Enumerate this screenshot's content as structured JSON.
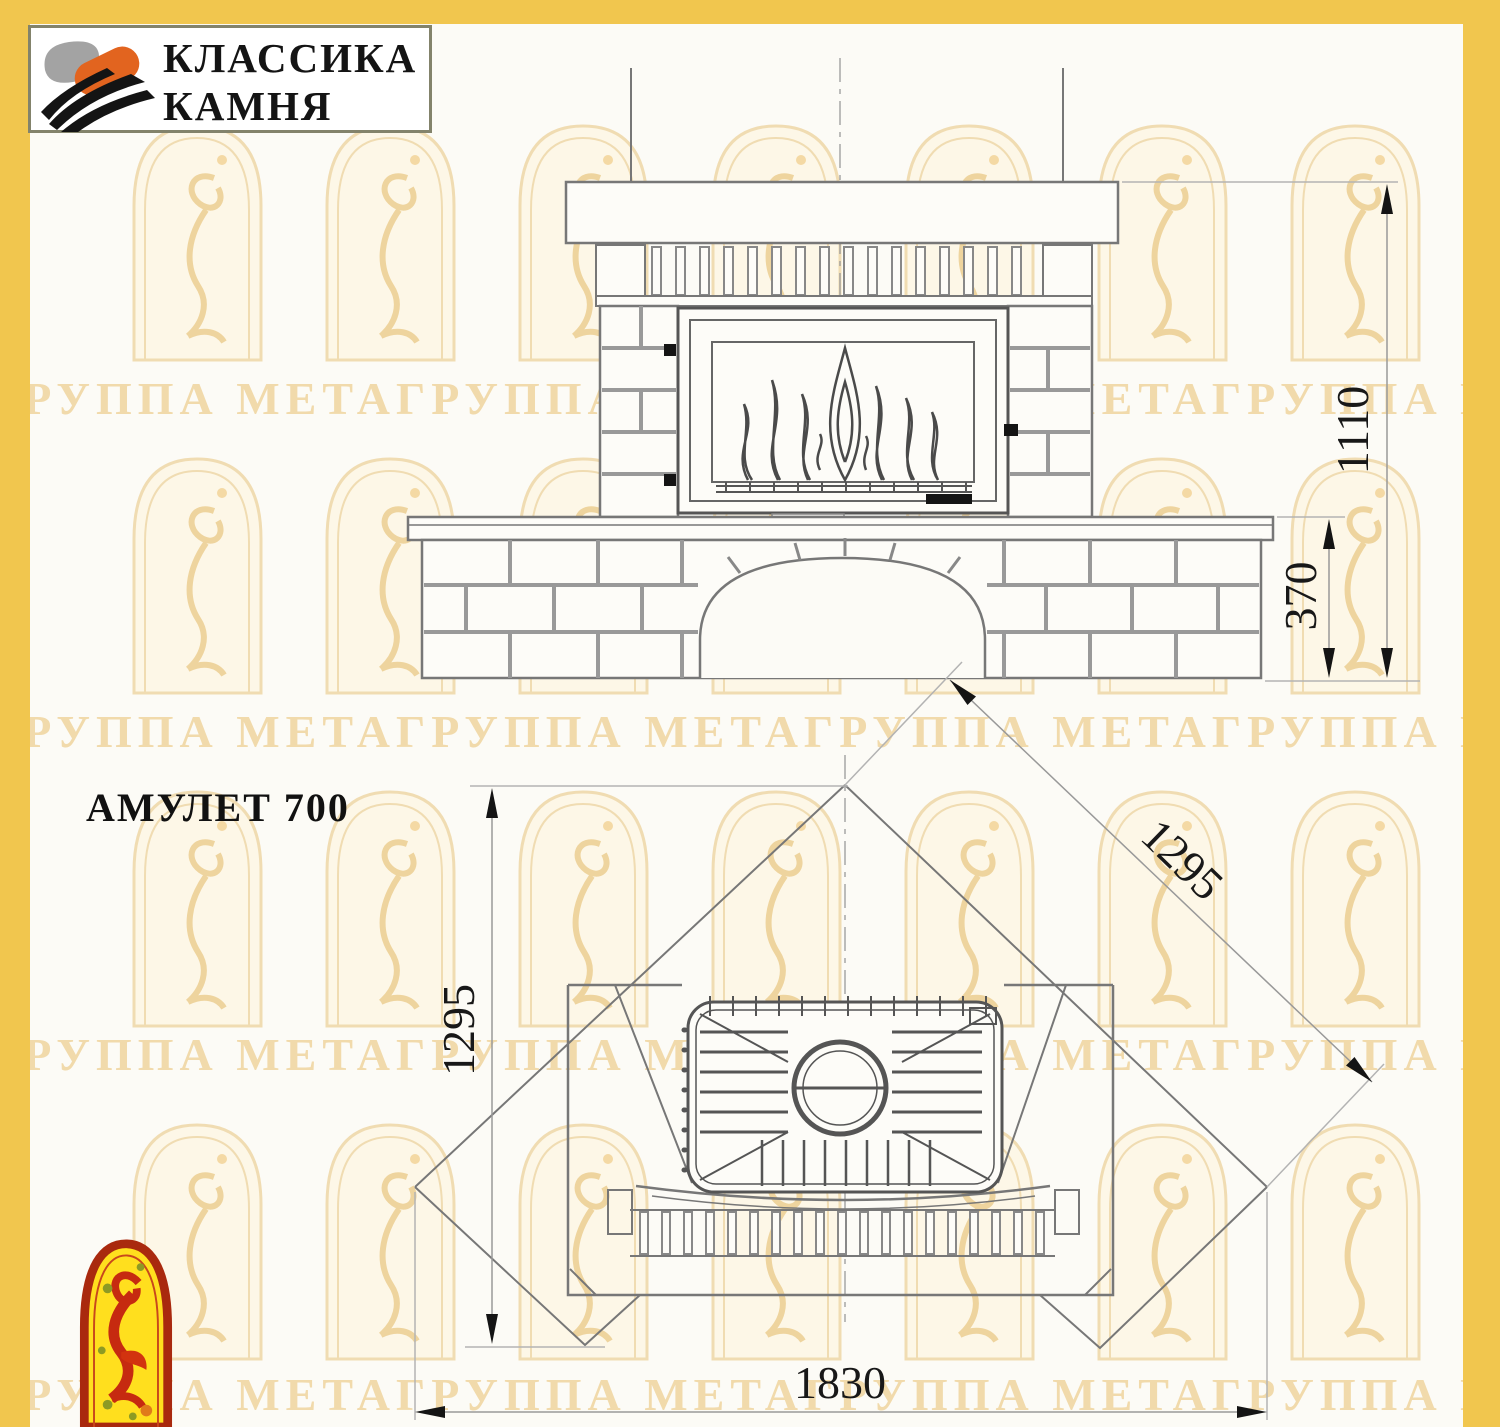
{
  "logo": {
    "line1": "КЛАССИКА",
    "line2": "КАМНЯ"
  },
  "title": "АМУЛЕТ 700",
  "watermark": {
    "text": "ГРУППА МЕТАГРУППА МЕТАГРУППА МЕТАГРУППА МЕТА ГРУППА МЕТАГРУППА"
  },
  "dims": {
    "total_height": "1110",
    "bench_height": "370",
    "side_left": "1295",
    "side_right": "1295",
    "front_width": "1830"
  },
  "colors": {
    "accent_yellow": "#f1c64e",
    "watermark_text": "#eed49e",
    "emblem_red": "#a9290e",
    "emblem_yellow": "#ffdf1e"
  }
}
